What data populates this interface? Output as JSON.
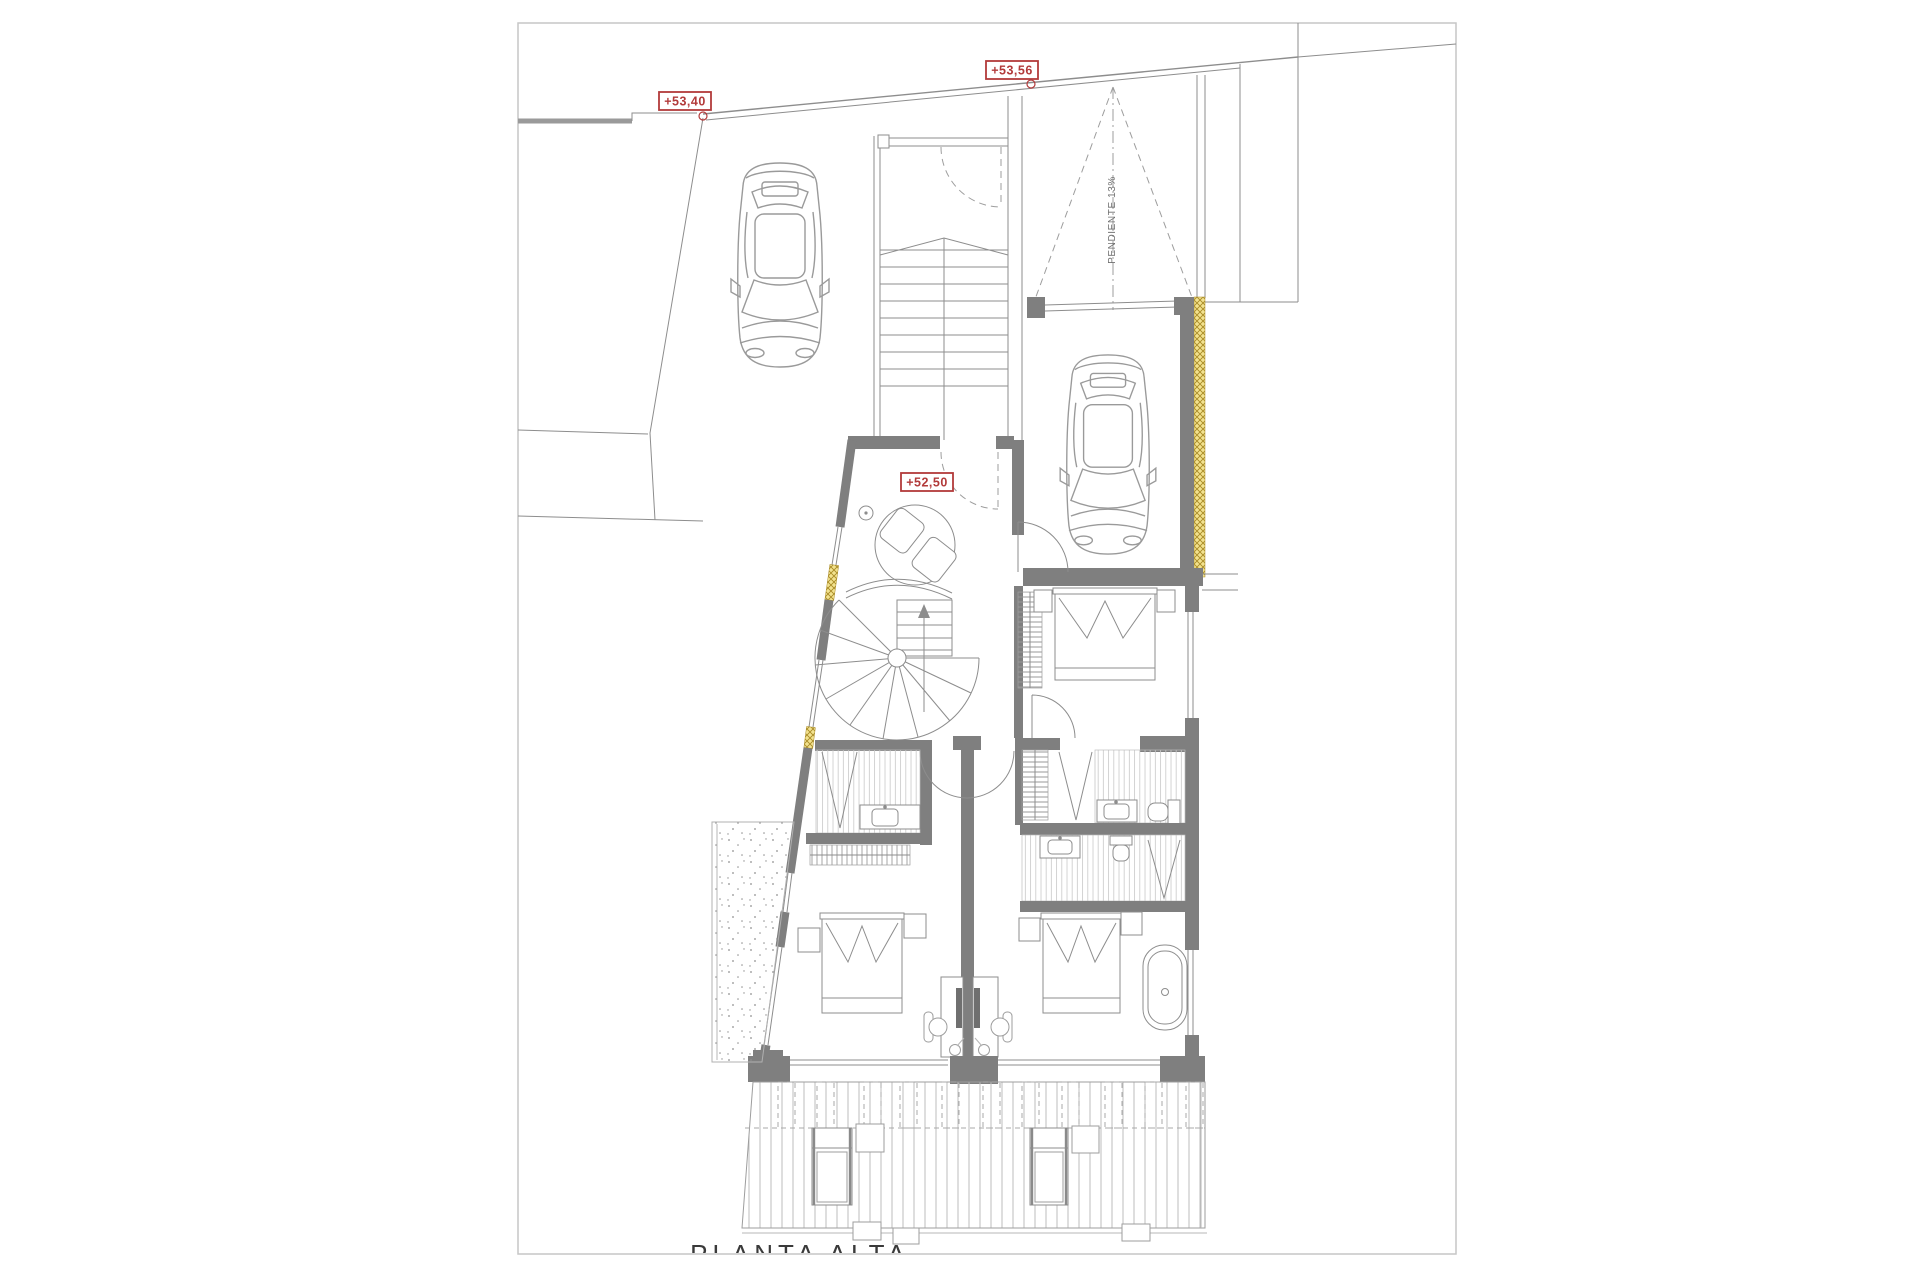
{
  "sheet": {
    "title": "PLANTA ALTA"
  },
  "elevation_markers": {
    "parking": "+53,40",
    "ramp_top": "+53,56",
    "landing": "+52,50"
  },
  "annotations": {
    "ramp_slope": "PENDIENTE 13%"
  },
  "colors": {
    "wall_gray": "#7f7f7f",
    "insulation_yellow": "#f2e28f",
    "insulation_hatch": "#a98a25",
    "marker_red": "#b23a3a",
    "drawing_line": "#8d8d8d",
    "paper_white": "#ffffff"
  }
}
